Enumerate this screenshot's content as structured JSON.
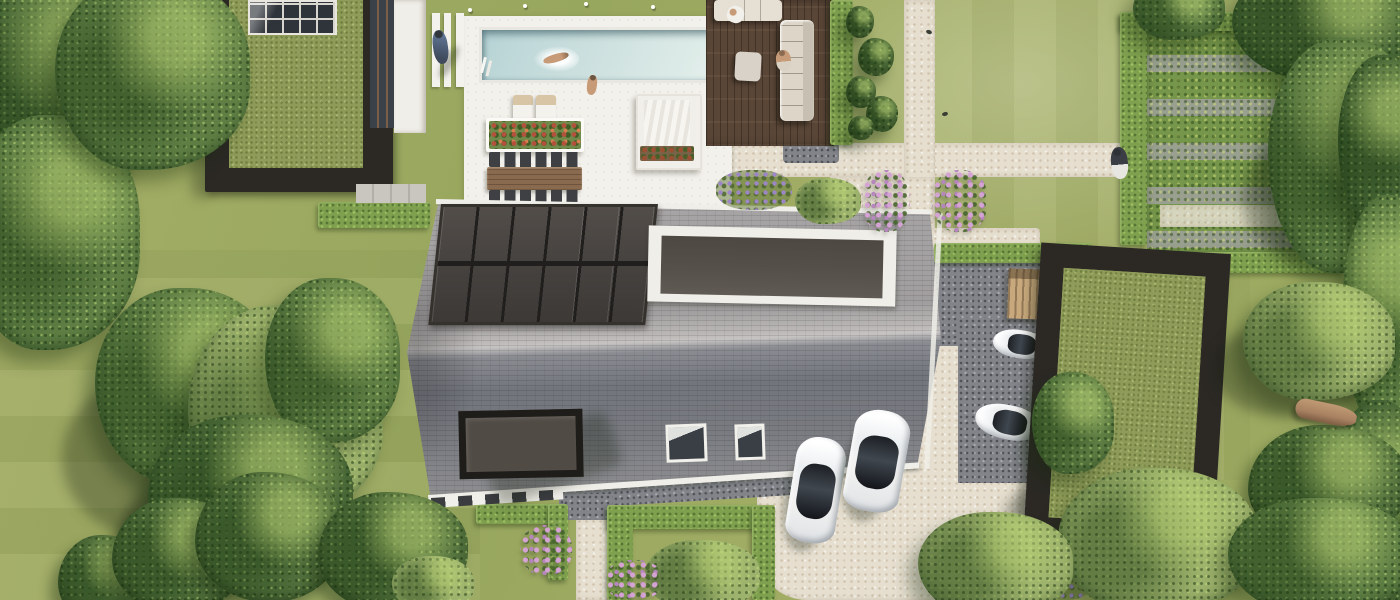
{
  "scene": {
    "title": "Aerial top-down 3D rendering of a modern villa property with pool, gardens and carport",
    "labels": {
      "main_house": "Main house with grey tiled roof, solar array and dormers",
      "solar_array": "Rooftop solar panel array (6x2 panels)",
      "garden_house": "Garden house with sedum green roof and skylight",
      "pool": "Swimming pool with swimmer",
      "pool_terrace": "White pool terrace with loungers, planter and dining set",
      "daybed": "Covered daybed lounge",
      "deck": "Dark timber lounge deck with outdoor sofa",
      "carport": "Open carport frame with sedum green roof",
      "driveway": "Light gravel driveway with parked cars",
      "cars": "Four white cars",
      "vegetable_garden": "Hedge-enclosed vegetable garden with crop rows",
      "lawn": "Mown lawn",
      "trees": "Mature trees and shrubs",
      "flowers": "Hydrangea and lavender flowering shrubs",
      "paths": "Light gravel garden paths"
    }
  },
  "palette": {
    "lawn": "#a4ae66",
    "lawn-2": "#98a75e",
    "tree": "#5f7f45",
    "tree-dark": "#4b6a39",
    "tree-light": "#87a358",
    "conifer": "#52713d",
    "bush-light": "#9db26c",
    "hedge": "#7fa04f",
    "sedum": "#8f9c59",
    "soil": "#9aa08f",
    "crop": "#76964b",
    "gravel-light": "#e6dfd0",
    "gravel-dark": "#82848a",
    "deck-wood": "#5a4637",
    "patio": "#f3f1ec",
    "roof-north": "#a19e9f",
    "roof-south": "#72757c",
    "solar": "#474340",
    "dormer": "#56504b",
    "frame-dark": "#2c2925",
    "fascia": "#f0eee8",
    "pool-1": "#b7d3d5",
    "pool-2": "#e3efeb",
    "car-body": "#f2f2f1",
    "car-glass": "#272b31",
    "flower-pink": "#d5a3d3",
    "flower-purple": "#9d86c6",
    "flower-red": "#b4503c",
    "skin": "#c89b78",
    "wood-shed": "#c8a97d",
    "table-wood": "#8a6a4e",
    "log": "#a98262",
    "shadow": "rgba(25,35,18,0.32)"
  }
}
